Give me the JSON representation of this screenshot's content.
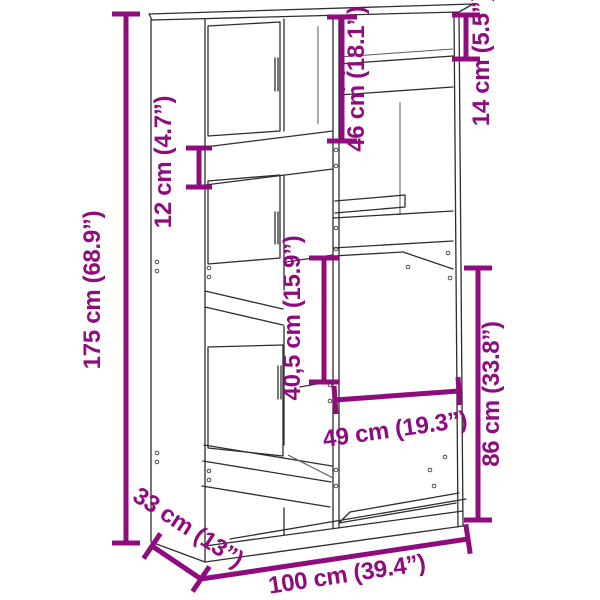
{
  "diagram": {
    "kind": "furniture-dimension-diagram",
    "subject": "bookcase-room-divider-line-drawing",
    "accent_color": "#8E0C7E",
    "line_color": "#2e2e2e",
    "background_color": "#ffffff",
    "dimensions": {
      "height": {
        "label": "175 cm (68.9”)"
      },
      "width": {
        "label": "100 cm (39.4”)"
      },
      "depth": {
        "label": "33 cm (13”)"
      },
      "upper_left_opening": {
        "label": "46 cm (18.1”)"
      },
      "top_right_opening": {
        "label": "14 cm (5.5”)"
      },
      "left_slot": {
        "label": "12 cm (4.7”)"
      },
      "middle_opening": {
        "label": "40,5 cm (15.9”)"
      },
      "lower_right_opening": {
        "label": "86 cm (33.8”)"
      },
      "lower_right_width": {
        "label": "49 cm (19.3”)"
      }
    }
  }
}
